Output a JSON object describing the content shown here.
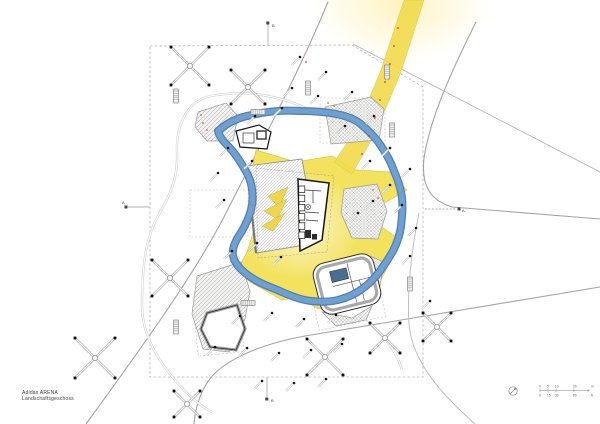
{
  "title_block": {
    "line1": "Adidas ARENA",
    "line2": "Landschaftsgeschoss"
  },
  "colors": {
    "ribbon_outer": "#4D7DB2",
    "ribbon_inner": "#6FA0D0",
    "plaza_yellow": "#F3E156",
    "band_yellow": "#F1DC4F",
    "glow": "#FFF2BE",
    "road": "#A3A3A3",
    "boundary": "#B5B5B5",
    "walkway": "#D2D2D2",
    "building_line": "#161616",
    "pool_blue": "#4A6E8F",
    "orange_dot": "#E06A2E",
    "red_dot": "#D03B2F",
    "text": "#444444"
  },
  "scale_bar": {
    "x0": 540,
    "x1": 590,
    "y": 390.5,
    "ticks": [
      540,
      548,
      556,
      574,
      588
    ],
    "top_labels": [
      "0",
      "5",
      "10",
      "20",
      "m"
    ],
    "bottom_labels": [
      "0",
      "15",
      "30",
      "60",
      "ft"
    ],
    "top_positions": [
      539,
      547,
      555,
      573,
      591
    ],
    "bottom_positions": [
      539,
      547,
      555,
      573,
      591
    ]
  },
  "north_icon": {
    "cx": 513,
    "cy": 391,
    "r": 4.2
  },
  "section_markers": [
    {
      "label": "B",
      "lx": 272,
      "ly": 27,
      "line": "M268,46 L268,24",
      "bx": 266.3,
      "by": 21.5,
      "dash": false
    },
    {
      "label": "B",
      "lx": 271,
      "ly": 402,
      "line": "M267,377 L267,397",
      "bx": 265.3,
      "by": 397.5,
      "dash": false
    },
    {
      "label": "A",
      "lx": 122,
      "ly": 204,
      "line": "M150,207 L128,207",
      "bx": 124.5,
      "by": 205.5,
      "dash": false
    },
    {
      "label": "A",
      "lx": 462,
      "ly": 212,
      "line": "M425,209 L456,209",
      "bx": 457.5,
      "by": 207.5,
      "dash": true
    }
  ],
  "plan": {
    "glow_top": {
      "cx": 402,
      "cy": 4,
      "rx": 90,
      "ry": 58
    },
    "plaza_glow": {
      "cx": 300,
      "cy": 225,
      "rx": 62,
      "ry": 55
    },
    "boundary": "M150,46 L352,45 L423,87 L423,377 L150,377 Z",
    "roads": [
      {
        "d": "M328,2 C300,70 258,150 225,215 C196,272 140,350 86,424",
        "w": 1.1,
        "c": "#A3A3A3"
      },
      {
        "d": "M476,22 C452,70 430,118 424,158 C421,186 430,200 452,207 L600,219",
        "w": 1.1,
        "c": "#A3A3A3"
      },
      {
        "d": "M600,287 L305,336 C266,343 238,355 221,368 C205,380 196,400 194,424",
        "w": 1.1,
        "c": "#A3A3A3"
      },
      {
        "d": "M419,213 C411,252 407,292 409,324 C411,352 430,382 462,412 L475,424",
        "w": 0.9,
        "c": "#B8B8B8"
      },
      {
        "d": "M353,44 L600,172",
        "w": 0.8,
        "c": "#B0B0B0"
      }
    ],
    "dashed_rects": [
      {
        "x": 320,
        "y": 98,
        "w": 65,
        "h": 45,
        "rot": 0,
        "cx": 352,
        "cy": 120
      },
      {
        "x": 190,
        "y": 190,
        "w": 58,
        "h": 47,
        "rot": 0,
        "cx": 219,
        "cy": 213
      },
      {
        "x": 312,
        "y": 262,
        "w": 68,
        "h": 62,
        "rot": -12,
        "cx": 346,
        "cy": 293
      },
      {
        "x": 196,
        "y": 310,
        "w": 46,
        "h": 44,
        "rot": -6,
        "cx": 219,
        "cy": 332
      }
    ],
    "walkways": [
      "M207,97 C185,104 176,128 177,152 C178,176 172,192 158,216 C146,238 142,264 142,306 C142,332 156,362 186,392 C196,402 204,408 212,412",
      "M207,97 C240,89 275,94 308,109",
      "M372,326 C390,342 398,356 402,370"
    ],
    "band_polygon": "404,0 424,0 401,72 375,134 352,174 334,162 356,130 381,70",
    "plaza_polygon": "256,150 296,162 332,156 356,170 390,172 407,190 381,205 369,218 397,238 391,260 374,294 344,306 318,309 299,297 282,300 250,282 237,271 247,252 254,230 257,205 250,178",
    "ribbon": "M218,131 C228,122 240,117 252,115 C268,111 286,110 300,111 C314,111 326,112 336,114 C347,116 355,119 362,125 C370,132 376,138 381,146 C387,155 391,162 394,171 C398,180 401,189 402,198 C403,208 402,217 401,226 C400,235 397,243 393,251 C389,258 385,264 380,271 C374,279 369,284 362,289 C354,295 346,298 338,300 C329,302 319,302 311,301 C301,300 291,296 282,292 C273,288 264,285 257,281 C250,277 243,272 238,266 C234,261 232,256 233,250 C234,243 238,237 242,231 C246,224 249,217 251,210 C253,202 253,196 252,189 C251,181 248,174 244,168 C240,161 234,152 228,146 C223,141 219,136 218,131 Z",
    "blobs": [
      {
        "pts": "198,112 226,103 238,116 233,141 207,141 195,127",
        "pat": "dhatch"
      },
      {
        "pts": "325,107 371,97 384,109 379,140 331,144",
        "pat": "xhatch"
      },
      {
        "pts": "344,189 377,184 387,211 378,239 352,238 341,213",
        "pat": "xhatch"
      },
      {
        "pts": "197,276 241,262 250,291 245,319 229,352 203,349 192,314",
        "pat": "dhatch"
      },
      {
        "pts": "370,256 384,262 380,286 370,282",
        "pat": "xhatch"
      },
      {
        "pts": "322,312 352,318 372,306 366,320 336,326",
        "pat": "xhatch"
      }
    ],
    "courtyard": {
      "pts": "207,313 237,305 245,329 236,350 210,347 201,329"
    },
    "buildings": [
      {
        "t": "poly",
        "pts": "247,166 302,159 317,243 256,253",
        "fill": "url(#stripes)",
        "stroke": "#8A8A8A",
        "sw": 0.8
      },
      {
        "t": "path",
        "d": "M247,166 L256,253",
        "stroke": "#777777",
        "sw": 2.2
      },
      {
        "t": "poly",
        "pts": "256,168 334,176 327,252 258,258",
        "stroke": "#999999",
        "sw": 0.5,
        "dash": "2,1.6"
      },
      {
        "t": "poly",
        "pts": "268,196 288,187 279,207",
        "fill": "#EDD64B",
        "stroke": "#C8B23A",
        "sw": 0.5
      },
      {
        "t": "poly",
        "pts": "264,211 287,199 277,219",
        "fill": "#EDD64B",
        "stroke": "#C8B23A",
        "sw": 0.5
      },
      {
        "t": "poly",
        "pts": "262,226 285,213 273,231",
        "fill": "#EDD64B",
        "stroke": "#C8B23A",
        "sw": 0.5
      },
      {
        "t": "poly",
        "pts": "298,179 329,183 322,240 300,251",
        "fill": "#FFFFFF",
        "stroke": "#161616",
        "sw": 1.5
      },
      {
        "t": "rect",
        "x": 298.8,
        "y": 186,
        "w": 6,
        "h": 6.5,
        "fill": "#FFFFFF",
        "stroke": "#161616",
        "sw": 0.7
      },
      {
        "t": "rect",
        "x": 298.8,
        "y": 195.2,
        "w": 6,
        "h": 6.5,
        "fill": "#FFFFFF",
        "stroke": "#161616",
        "sw": 0.7
      },
      {
        "t": "rect",
        "x": 298.8,
        "y": 204.4,
        "w": 6,
        "h": 6.5,
        "fill": "#FFFFFF",
        "stroke": "#161616",
        "sw": 0.7
      },
      {
        "t": "rect",
        "x": 298.8,
        "y": 213.6,
        "w": 6,
        "h": 6.5,
        "fill": "#FFFFFF",
        "stroke": "#161616",
        "sw": 0.7
      },
      {
        "t": "rect",
        "x": 298.8,
        "y": 222.8,
        "w": 6,
        "h": 6.5,
        "fill": "#FFFFFF",
        "stroke": "#161616",
        "sw": 0.7
      },
      {
        "t": "rect",
        "x": 298.8,
        "y": 232,
        "w": 6,
        "h": 6.5,
        "fill": "#FFFFFF",
        "stroke": "#161616",
        "sw": 0.7
      },
      {
        "t": "circle",
        "cx": 308,
        "cy": 207,
        "r": 2.6,
        "stroke": "#333333",
        "sw": 0.6
      },
      {
        "t": "path",
        "d": "M306.2,205.2 L309.8,208.8 M306.2,208.8 L309.8,205.2",
        "stroke": "#333333",
        "sw": 0.5
      },
      {
        "t": "path",
        "d": "M305,190 L321,191 M313,191 L313,203 M305,212 L319,213 M306,220 L318,221",
        "stroke": "#333333",
        "sw": 0.7
      },
      {
        "t": "rect",
        "x": 305,
        "y": 230,
        "w": 6,
        "h": 8,
        "fill": "#2D2D2D"
      },
      {
        "t": "rect",
        "x": 312,
        "y": 234,
        "w": 5,
        "h": 5.5,
        "fill": "#2D2D2D"
      },
      {
        "t": "g_rot",
        "rot": -14,
        "cx": 347,
        "cy": 284,
        "items": [
          {
            "t": "rect",
            "x": 316,
            "y": 258,
            "w": 62,
            "h": 52,
            "rx": 12,
            "fill": "#FFFFFF",
            "stroke": "#1D1D1D",
            "sw": 0.9
          },
          {
            "t": "rect",
            "x": 320,
            "y": 262,
            "w": 54,
            "h": 44,
            "rx": 9,
            "stroke": "#A9A9A9",
            "sw": 3.2
          },
          {
            "t": "rect",
            "x": 333,
            "y": 268,
            "w": 17,
            "h": 11,
            "fill": "#4A6E8F",
            "stroke": "#1D1D1D",
            "sw": 0.5
          },
          {
            "t": "path",
            "d": "M352,264 L352,304 M333,283 L372,283 M360,283 L360,304",
            "stroke": "#444444",
            "sw": 0.6
          }
        ]
      },
      {
        "t": "poly",
        "pts": "236,131 259,125 271,132 267,149 240,147",
        "fill": "#FFFFFF",
        "stroke": "#141414",
        "sw": 1.2
      },
      {
        "t": "rect",
        "x": 243,
        "y": 133,
        "w": 11,
        "h": 10,
        "fill": "#FFFFFF",
        "stroke": "#333333",
        "sw": 0.7
      },
      {
        "t": "rect",
        "x": 257,
        "y": 131,
        "w": 9,
        "h": 8,
        "fill": "#FFFFFF",
        "stroke": "#333333",
        "sw": 1.4
      }
    ],
    "trees": [
      [
        190,
        66,
        19
      ],
      [
        248,
        87,
        17
      ],
      [
        170,
        278,
        18
      ],
      [
        95,
        358,
        20
      ],
      [
        325,
        357,
        18
      ],
      [
        385,
        338,
        15
      ],
      [
        187,
        404,
        13
      ],
      [
        437,
        327,
        14
      ]
    ],
    "lamps": [
      [
        300,
        57
      ],
      [
        326,
        72
      ],
      [
        292,
        88
      ],
      [
        318,
        96
      ],
      [
        352,
        92
      ],
      [
        255,
        116
      ],
      [
        282,
        108
      ],
      [
        345,
        126
      ],
      [
        374,
        116
      ],
      [
        228,
        148
      ],
      [
        252,
        161
      ],
      [
        390,
        148
      ],
      [
        410,
        169
      ],
      [
        218,
        173
      ],
      [
        370,
        161
      ],
      [
        390,
        185
      ],
      [
        224,
        200
      ],
      [
        358,
        213
      ],
      [
        373,
        201
      ],
      [
        402,
        205
      ],
      [
        232,
        251
      ],
      [
        257,
        243
      ],
      [
        281,
        257
      ],
      [
        240,
        316
      ],
      [
        272,
        313
      ],
      [
        304,
        319
      ],
      [
        336,
        315
      ],
      [
        215,
        347
      ],
      [
        247,
        348
      ],
      [
        279,
        353
      ],
      [
        311,
        350
      ],
      [
        342,
        344
      ],
      [
        262,
        381
      ],
      [
        294,
        383
      ],
      [
        326,
        379
      ],
      [
        410,
        256
      ],
      [
        416,
        228
      ],
      [
        430,
        301
      ]
    ],
    "benches": [
      [
        176,
        96,
        "v"
      ],
      [
        308,
        88,
        "v"
      ],
      [
        258,
        112,
        "h"
      ],
      [
        392,
        130,
        "v"
      ],
      [
        248,
        303,
        "h"
      ],
      [
        176,
        327,
        "v"
      ],
      [
        410,
        284,
        "v"
      ],
      [
        387,
        72,
        "v"
      ]
    ],
    "orange_dots": [
      [
        201,
        115
      ],
      [
        203,
        123
      ],
      [
        207,
        130
      ],
      [
        328,
        103
      ],
      [
        334,
        106
      ],
      [
        373,
        190
      ],
      [
        378,
        198
      ],
      [
        366,
        282
      ],
      [
        371,
        286
      ],
      [
        252,
        205
      ],
      [
        254,
        213
      ]
    ],
    "red_dots": [
      [
        398,
        28
      ],
      [
        394,
        46
      ],
      [
        390,
        64
      ],
      [
        385,
        82
      ],
      [
        380,
        100
      ],
      [
        375,
        118
      ],
      [
        369,
        136
      ],
      [
        362,
        154
      ],
      [
        306,
        62
      ]
    ]
  }
}
